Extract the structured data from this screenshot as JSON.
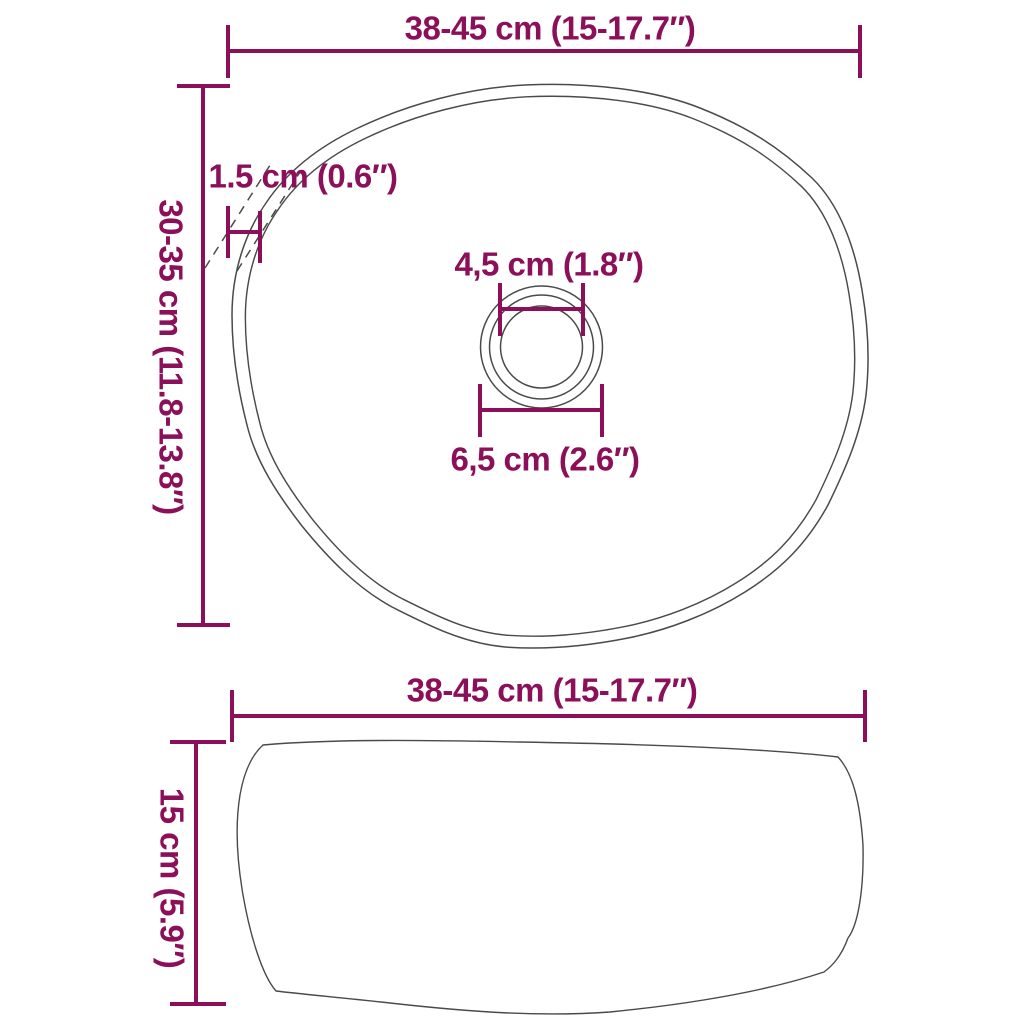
{
  "colors": {
    "accent": "#8B1059",
    "outline": "#4A4A4A",
    "background": "#FFFFFF"
  },
  "top_view": {
    "width_label": "38-45 cm (15-17.7″)",
    "height_label": "30-35 cm (11.8-13.8″)",
    "rim_thickness_label": "1.5 cm (0.6″)",
    "drain_inner_label": "4,5 cm (1.8″)",
    "drain_outer_label": "6,5 cm (2.6″)"
  },
  "side_view": {
    "width_label": "38-45 cm (15-17.7″)",
    "depth_label": "15 cm (5.9″)"
  }
}
